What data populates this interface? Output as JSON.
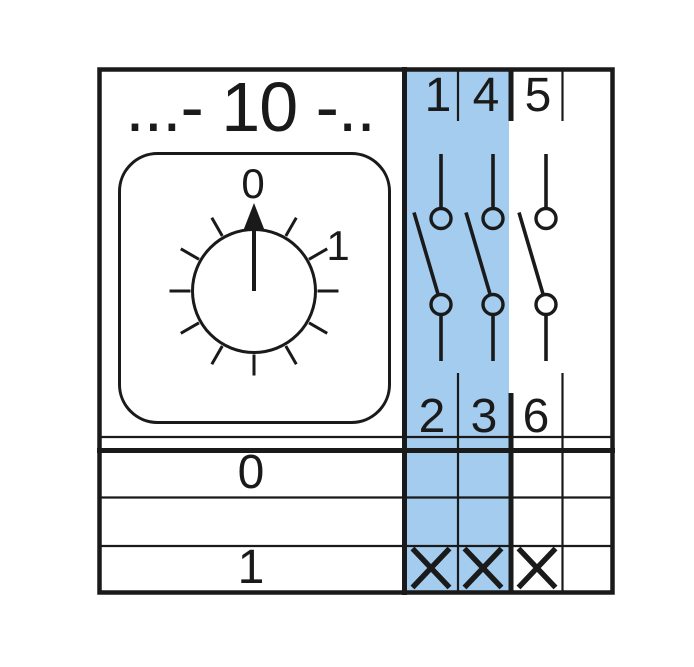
{
  "title": "...- 10 -..",
  "dial": {
    "top_label": "0",
    "right_label": "1"
  },
  "terminals": {
    "top": [
      "1",
      "4",
      "5"
    ],
    "bottom": [
      "2",
      "3",
      "6"
    ]
  },
  "table": {
    "rows": [
      {
        "position": "0",
        "contacts": [
          false,
          false,
          false,
          false
        ]
      },
      {
        "position": "",
        "contacts": [
          false,
          false,
          false,
          false
        ]
      },
      {
        "position": "1",
        "contacts": [
          true,
          true,
          true,
          false
        ]
      }
    ]
  },
  "colors": {
    "highlight_blue": "#A3CCEE",
    "line_black": "#1A1A1A"
  }
}
